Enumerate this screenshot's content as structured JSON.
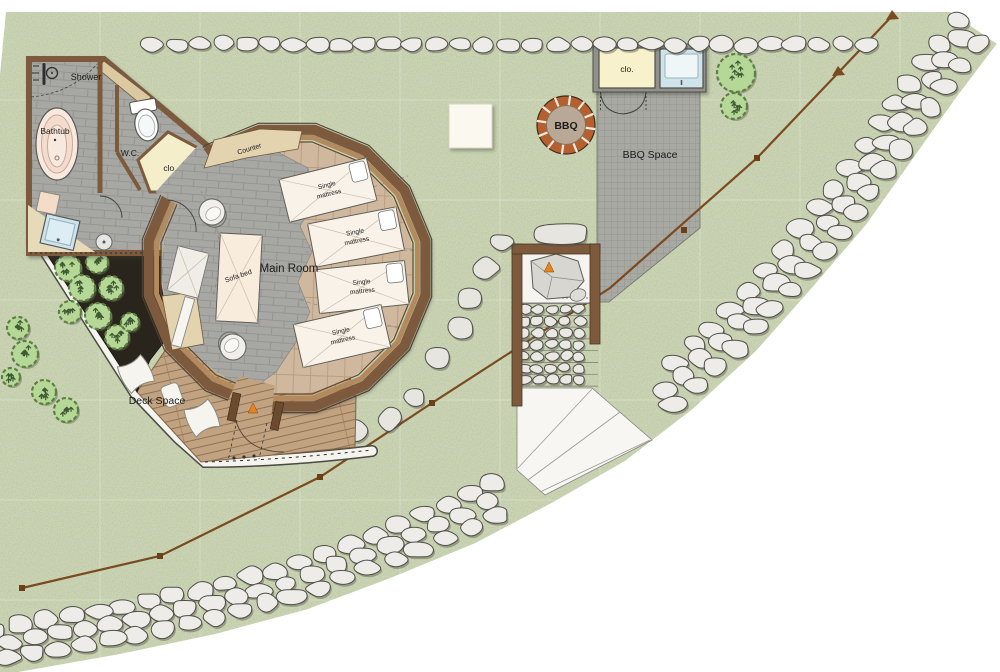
{
  "labels": {
    "shower": "Shower",
    "bathtub": "Bathtub",
    "wc": "W.C.",
    "closet_bath": "clo.",
    "counter": "Counter",
    "main_room": "Main Room",
    "sofa_bed": "Sofa bed",
    "mattress_line1": "Single",
    "mattress_line2": "mattress",
    "deck": "Deck Space",
    "bbq": "BBQ",
    "bbq_space": "BBQ Space",
    "closet_bbq": "clo."
  },
  "colors": {
    "grass": "#cbd4b4",
    "stone": "#edece8",
    "wall_brown": "#7d5a3c",
    "deck_wood": "#c2a381",
    "room_wood": "#d0b89e",
    "tile_gray": "#a7a7a3",
    "planter_dark": "#2a251c",
    "bush_green": "#b5d897",
    "water_blue": "#cfe3ea",
    "closet_cream": "#f7f2cb",
    "accent_orange": "#e8821e",
    "bbq_brick": "#b5602e"
  }
}
